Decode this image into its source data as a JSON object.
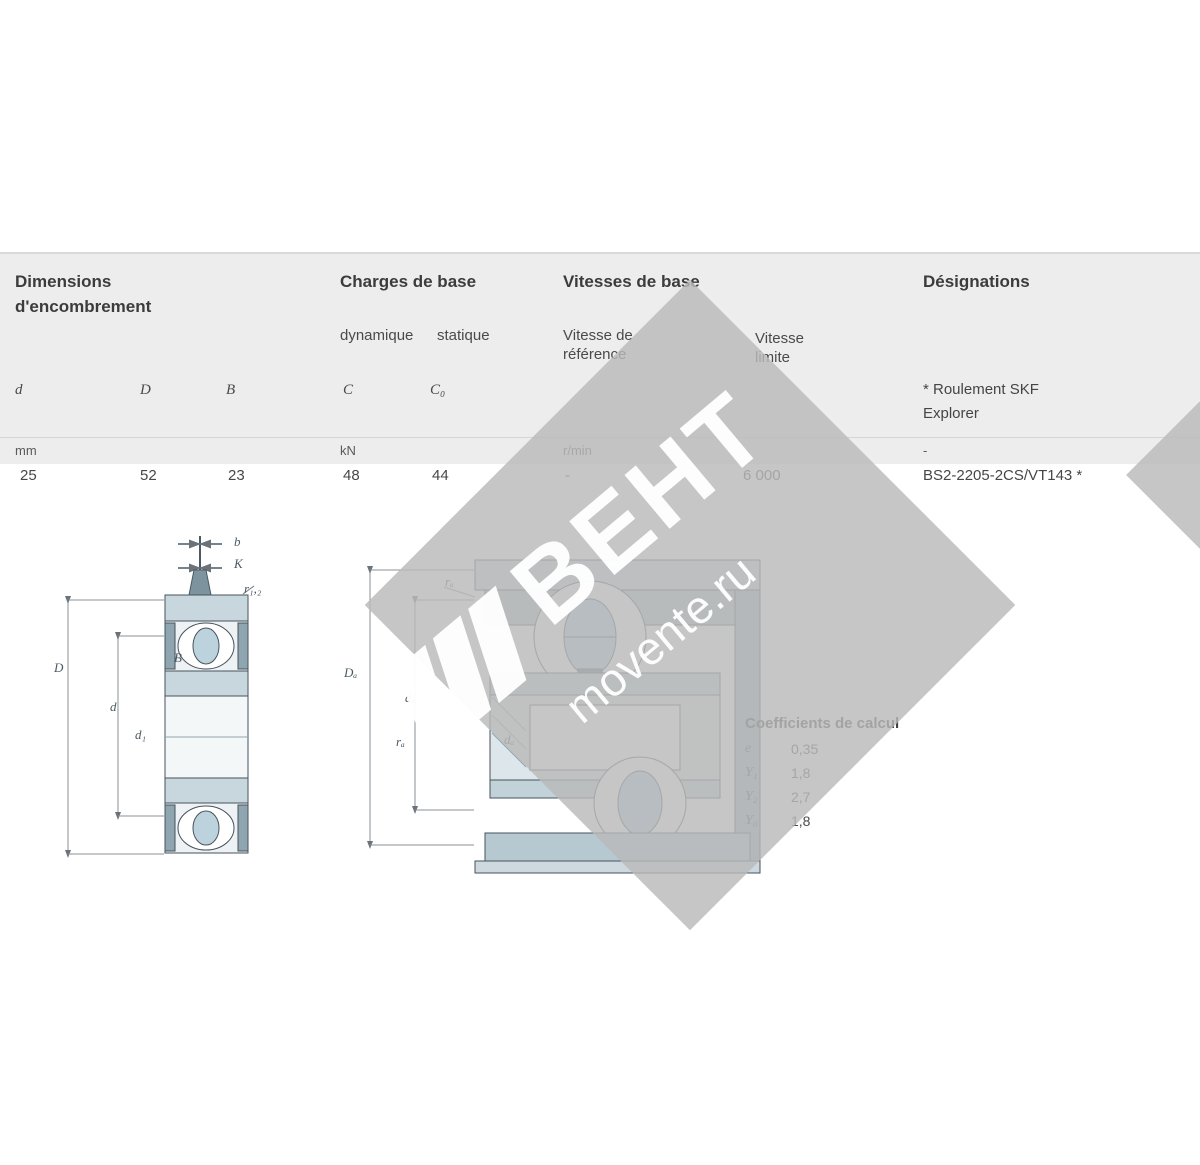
{
  "watermark": {
    "brand": "ВЕНТ",
    "site": "movente.ru"
  },
  "table": {
    "col_dimensions_line1": "Dimensions",
    "col_dimensions_line2": "d'encombrement",
    "col_loads": "Charges de base",
    "col_speeds": "Vitesses de base",
    "col_designations": "Désignations",
    "sub_dynamic": "dynamique",
    "sub_static": "statique",
    "sub_refspeed_line1": "Vitesse de",
    "sub_refspeed_line2": "référence",
    "sub_limspeed_line1": "Vitesse",
    "sub_limspeed_line2": "limite",
    "sym_d": "d",
    "sym_D": "D",
    "sym_B": "B",
    "sym_C": "C",
    "sym_C0": "C₀",
    "note_line1": "* Roulement SKF",
    "note_line2": "Explorer",
    "unit_dim": "mm",
    "unit_load": "kN",
    "unit_speed": "r/min",
    "unit_desig": "-",
    "row": {
      "d": "25",
      "D": "52",
      "B": "23",
      "C": "48",
      "C0": "44",
      "speed_ref": "-",
      "speed_lim": "6 000",
      "designation": "BS2-2205-2CS/VT143 *"
    }
  },
  "coefficients": {
    "title": "Coefficients de calcul",
    "rows": [
      {
        "symbol": "e",
        "value": "0,35"
      },
      {
        "symbol": "Y₁",
        "value": "1,8"
      },
      {
        "symbol": "Y₂",
        "value": "2,7"
      },
      {
        "symbol": "Y₀",
        "value": "1,8"
      }
    ]
  },
  "drawing_labels": [
    {
      "t": "b",
      "x": 234,
      "y": 534
    },
    {
      "t": "K",
      "x": 234,
      "y": 556
    },
    {
      "t": "r₁,₂",
      "x": 244,
      "y": 581
    },
    {
      "t": "D",
      "x": 54,
      "y": 660
    },
    {
      "t": "d",
      "x": 110,
      "y": 699
    },
    {
      "t": "d₁",
      "x": 135,
      "y": 727
    },
    {
      "t": "B",
      "x": 174,
      "y": 650
    },
    {
      "t": "rₐ",
      "x": 445,
      "y": 574
    },
    {
      "t": "Dₐ",
      "x": 344,
      "y": 665
    },
    {
      "t": "dₐ",
      "x": 405,
      "y": 690
    },
    {
      "t": "rₐ",
      "x": 396,
      "y": 734
    },
    {
      "t": "dₐ",
      "x": 504,
      "y": 732
    }
  ]
}
